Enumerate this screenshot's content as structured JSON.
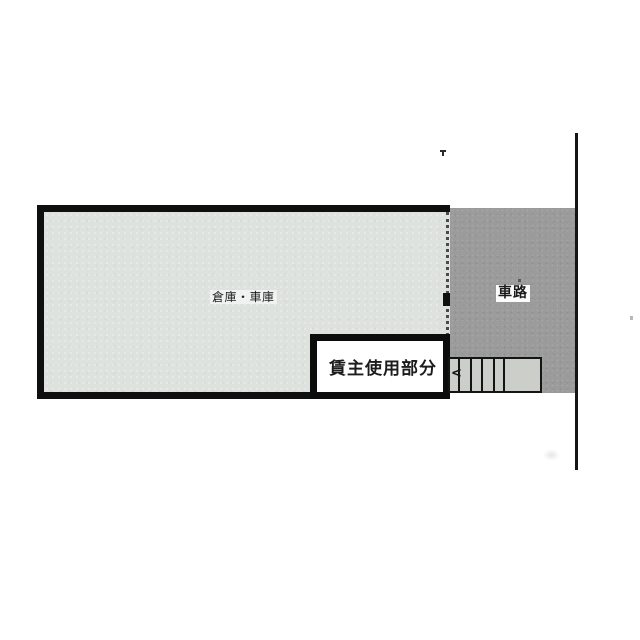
{
  "floorplan": {
    "warehouse_garage": {
      "label": "倉庫・車庫"
    },
    "landlord_area": {
      "label": "賃主使用部分"
    },
    "driveway": {
      "label": "車路"
    },
    "stairs": {
      "arrow": "<",
      "tread_count": 5
    },
    "colors": {
      "wall": "#0f0f0f",
      "room_fill": "#dde2df",
      "driveway_fill": "#9b9b9b",
      "stairs_fill": "#cbcec9",
      "landlord_box_fill": "#ffffff",
      "background": "#ffffff"
    }
  }
}
